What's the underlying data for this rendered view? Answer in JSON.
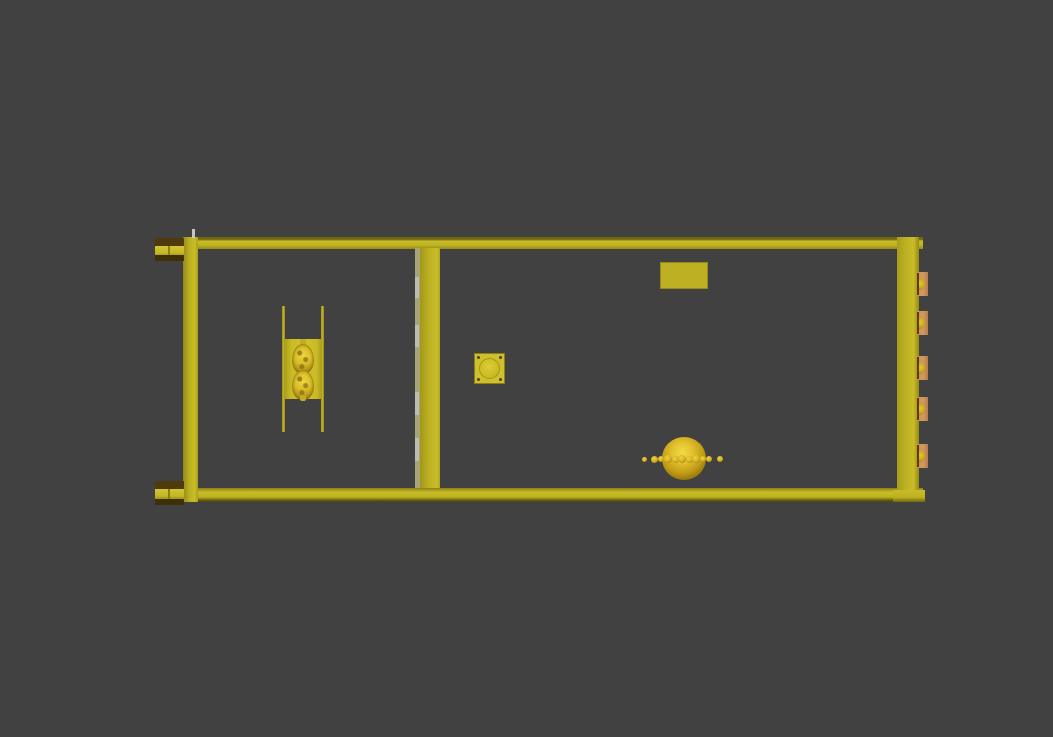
{
  "scene": {
    "colors": {
      "background": "#414141",
      "frame_yellow": "#bdb122",
      "frame_bright": "#c9bc28",
      "frame_edge": "#6e670e",
      "side_face": "#a9a477",
      "plate_yellow": "#cabb26",
      "port_tan": "#c98f57",
      "port_slit": "#5e3c10",
      "coupler_brown": "#4e3a0a",
      "gold_bright": "#f2d94a",
      "gold_dark": "#755c08",
      "hinge_gray": "#c0c0c0"
    },
    "counts": {
      "right_ports": 5,
      "left_couplers": 2,
      "divider_hinges": 4,
      "chain_beads": 11,
      "pods": 2
    },
    "ports_y": [
      272,
      311,
      356,
      397,
      444
    ],
    "hinges": [
      {
        "y": 277,
        "h": 21
      },
      {
        "y": 325,
        "h": 22
      },
      {
        "y": 392,
        "h": 23
      },
      {
        "y": 438,
        "h": 23
      }
    ],
    "beads": [
      {
        "cx": 644,
        "cy": 459,
        "d": 5
      },
      {
        "cx": 654,
        "cy": 459,
        "d": 7
      },
      {
        "cx": 661,
        "cy": 459,
        "d": 6
      },
      {
        "cx": 668,
        "cy": 459,
        "d": 8
      },
      {
        "cx": 675,
        "cy": 459,
        "d": 7
      },
      {
        "cx": 682,
        "cy": 459,
        "d": 8
      },
      {
        "cx": 689,
        "cy": 459,
        "d": 7
      },
      {
        "cx": 696,
        "cy": 459,
        "d": 8
      },
      {
        "cx": 703,
        "cy": 459,
        "d": 6
      },
      {
        "cx": 709,
        "cy": 459,
        "d": 6
      },
      {
        "cx": 720,
        "cy": 459,
        "d": 6
      }
    ]
  }
}
